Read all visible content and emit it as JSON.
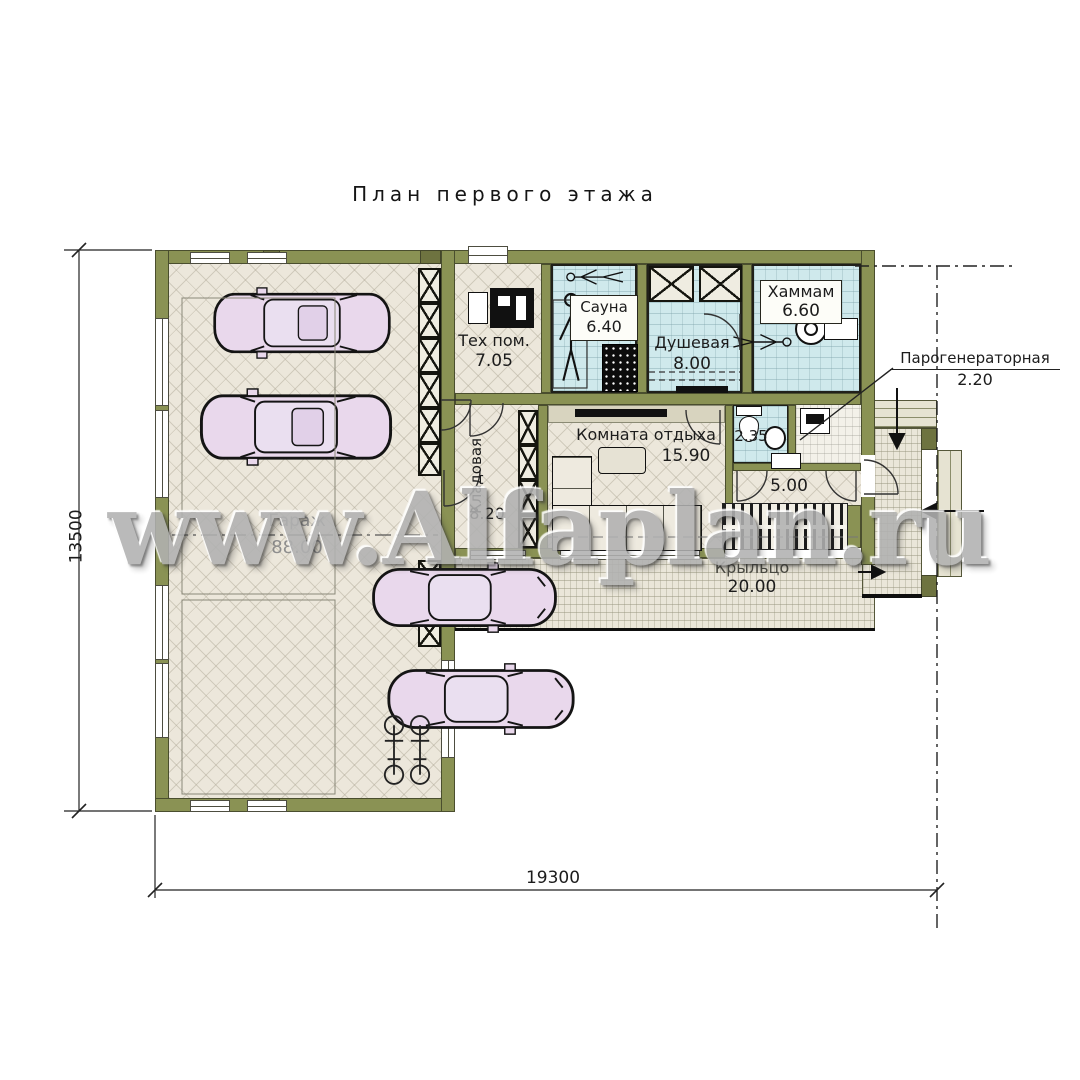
{
  "title": "План первого этажа",
  "watermark": "www.Alfaplan.ru",
  "rooms": {
    "garage": {
      "name": "Гараж",
      "area": "88.00"
    },
    "tech": {
      "name": "Тех пом.",
      "area": "7.05"
    },
    "sauna": {
      "name": "Сауна",
      "area": "6.40"
    },
    "shower": {
      "name": "Душевая",
      "area": "8.00"
    },
    "hammam": {
      "name": "Хаммам",
      "area": "6.60"
    },
    "lounge": {
      "name": "Комната отдыха",
      "area": "15.90"
    },
    "storage": {
      "name": "Кладовая",
      "area": "8.20"
    },
    "wc": {
      "area": "2.35"
    },
    "hall": {
      "area": "5.00"
    },
    "porch": {
      "name": "Крыльцо",
      "area": "20.00"
    },
    "steamgen": {
      "name": "Парогенераторная",
      "area": "2.20"
    }
  },
  "dimensions": {
    "bottom": "19300",
    "left": "13500"
  },
  "colors": {
    "wall": "#8a9254",
    "floor_cream": "#ece7db",
    "floor_wet": "#cfe9ec",
    "floor_porch": "#eae6d9",
    "car_fill": "#e9d8ec",
    "label_text": "#1c1c1c"
  },
  "icons": {
    "cars": "car-top-view",
    "bicycles": "bicycle-top-view",
    "persons": "human-figure",
    "stove": "sauna-stove",
    "bowl": "hammam-bowl",
    "toilet": "toilet",
    "shower_cabins": "crossed-box"
  }
}
